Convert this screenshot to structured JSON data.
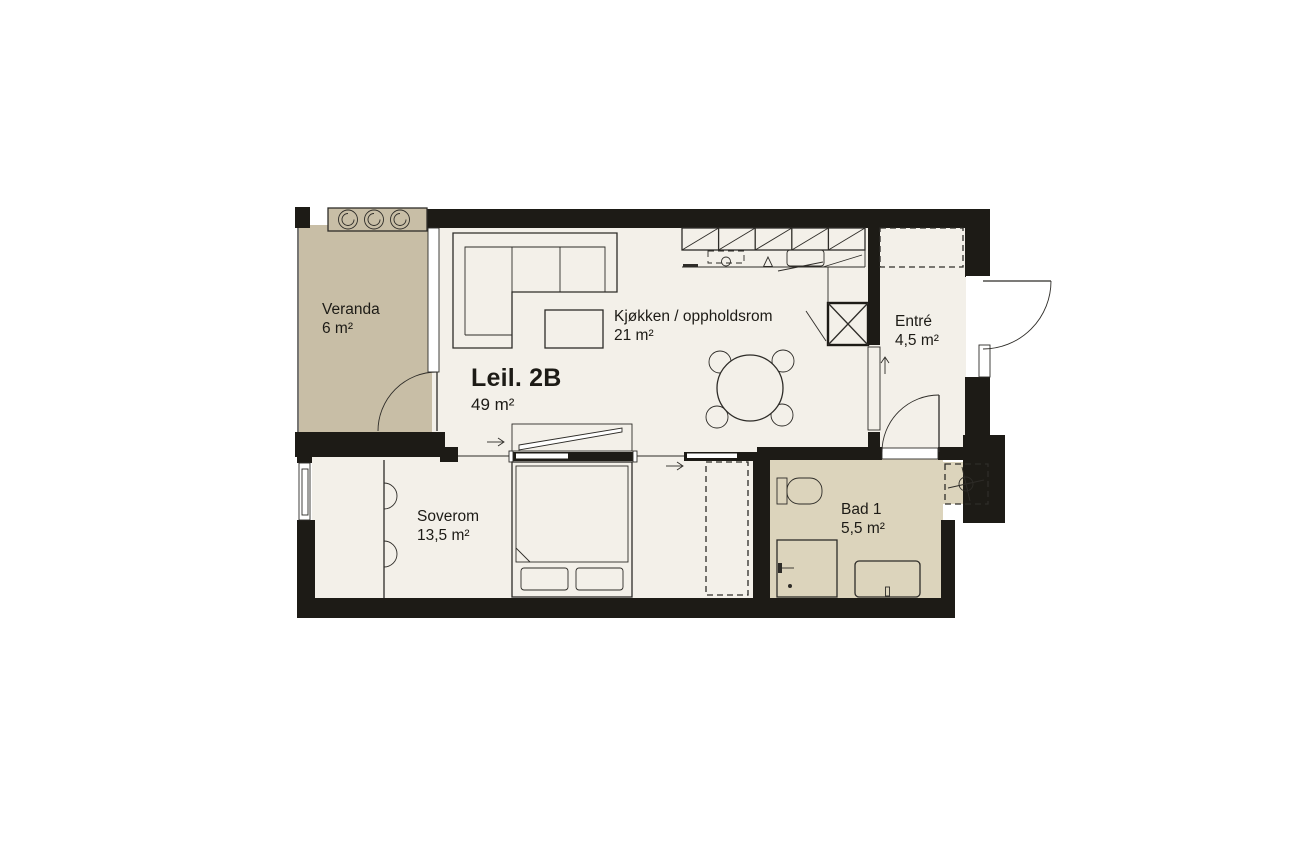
{
  "floorplan": {
    "unit": {
      "label": "Leil. 2B",
      "area": "49 m²"
    },
    "rooms": [
      {
        "id": "veranda",
        "label": "Veranda",
        "area": "6 m²"
      },
      {
        "id": "kitchen-living",
        "label": "Kjøkken / oppholdsrom",
        "area": "21 m²"
      },
      {
        "id": "entre",
        "label": "Entré",
        "area": "4,5 m²"
      },
      {
        "id": "bedroom",
        "label": "Soverom",
        "area": "13,5 m²"
      },
      {
        "id": "bathroom",
        "label": "Bad 1",
        "area": "5,5 m²"
      }
    ],
    "icons": [
      "plant-icon",
      "fan-icon",
      "shaft-cross-icon",
      "arrow-right-icon",
      "arrow-up-icon"
    ],
    "colors": {
      "background": "#ffffff",
      "floor": "#f3f0e9",
      "veranda": "#c8bea6",
      "bathroom": "#dcd4bc",
      "wall": "#1d1b16",
      "line": "#2e2c28",
      "ink": "#1d1b16"
    }
  }
}
